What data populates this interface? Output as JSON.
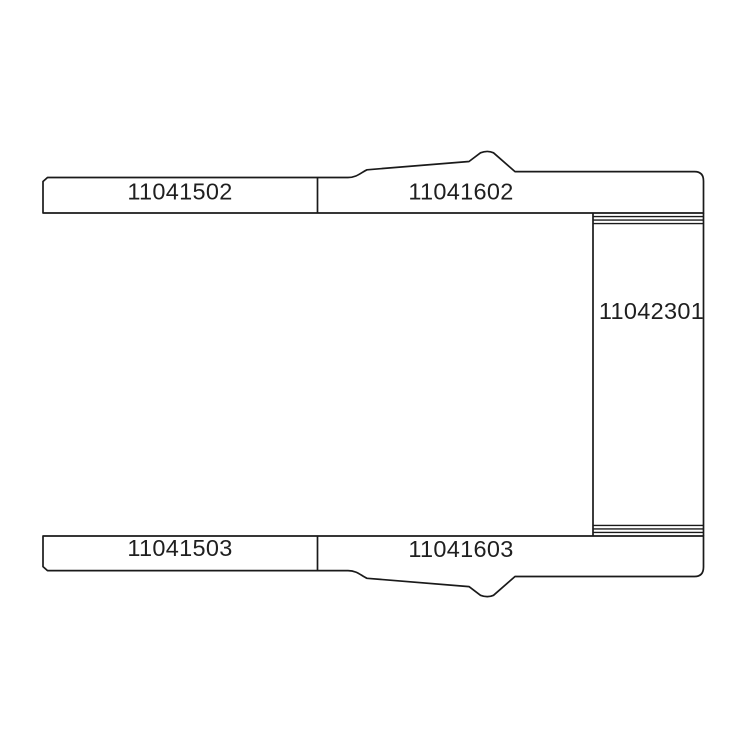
{
  "diagram": {
    "kind": "technical-parts-line-drawing",
    "colors": {
      "background": "#ffffff",
      "line": "#1a1a1a",
      "text": "#1f1f1f"
    },
    "parts": {
      "top_rail_front": {
        "part_number": "11041502"
      },
      "top_rail_rear": {
        "part_number": "11041602"
      },
      "cross_member": {
        "part_number": "11042301"
      },
      "bottom_rail_front": {
        "part_number": "11041503"
      },
      "bottom_rail_rear": {
        "part_number": "11041603"
      }
    }
  }
}
